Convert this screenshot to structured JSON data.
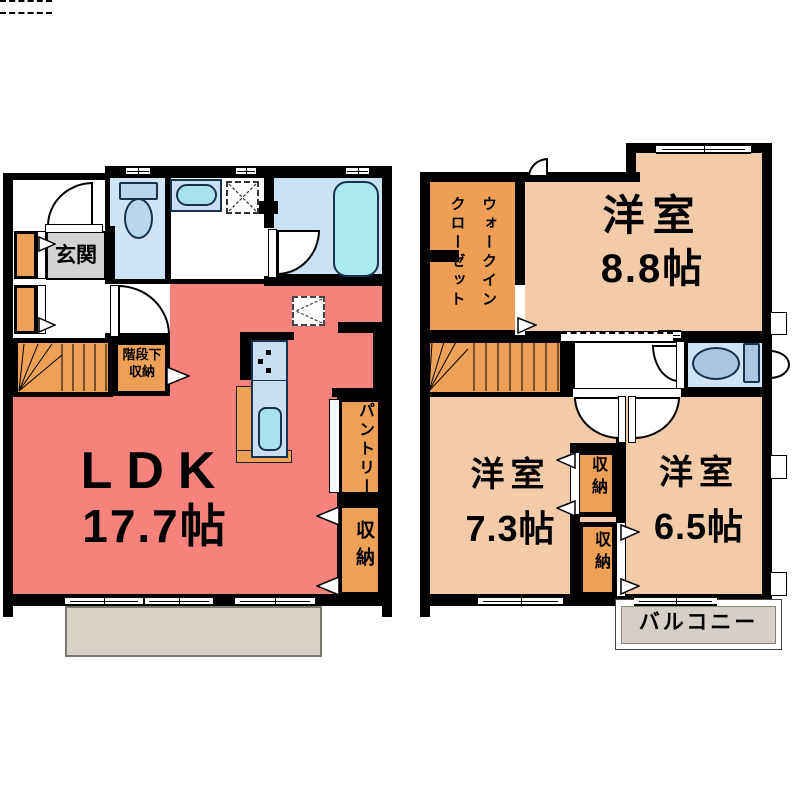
{
  "f1": {
    "entrance": "玄関",
    "under_stairs": "階段下収納",
    "ldk_name": "LDK",
    "ldk_size": "17.7帖",
    "pantry": "パントリー",
    "storage": "収納"
  },
  "f2": {
    "wic": "ウォークインクローゼット",
    "room_a_name": "洋室",
    "room_a_size": "8.8帖",
    "room_b_name": "洋室",
    "room_b_size": "7.3帖",
    "room_c_name": "洋室",
    "room_c_size": "6.5帖",
    "storage_a": "収納",
    "storage_b": "収納",
    "balcony": "バルコニー"
  },
  "colors": {
    "ldk_fill": "#F5837B",
    "bedroom_fill": "#F3CBA8",
    "storage_orange_fill": "#EFA057",
    "water_room_fill": "#CFE3F5",
    "bath_fill": "#CBE2F4",
    "fixture_blue": "#B9D6EF",
    "bathtub_cyan": "#ADE9F3",
    "terrace_grey": "#D8D1C8",
    "entrance_chip_grey": "#D3D3D3",
    "wall": "#000000"
  }
}
